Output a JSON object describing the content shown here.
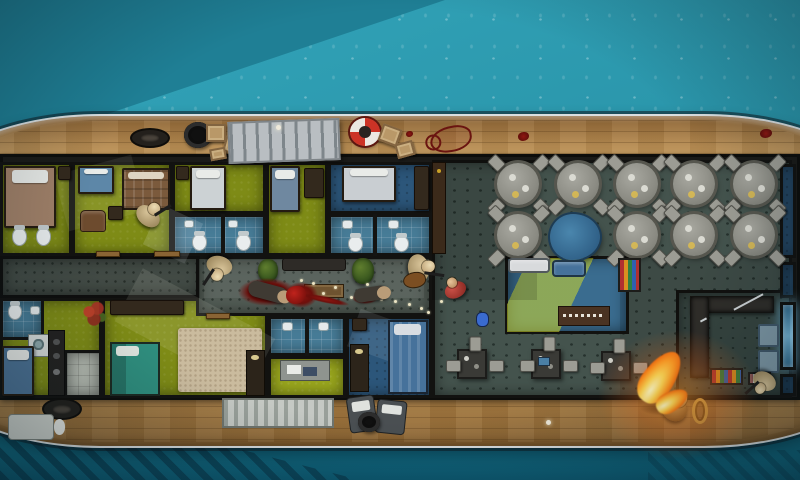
{
  "scene": {
    "description": "top-down-tactical-ship-raid-map",
    "environment": "yacht-on-teal-water",
    "palette": {
      "water_light": "#2e9db2",
      "water_dark": "#1f7f95",
      "water_deep": "#0d5a72",
      "hull_wood": "#c59a5d",
      "hull_rim": "#dadfe1",
      "wall": "#121210",
      "cabin_green": "#7e8b16",
      "bathroom_blue": "#477c97",
      "bedroom_blue": "#2c567a",
      "corridor_gray": "#515b54",
      "restaurant_gray": "#44534d",
      "blood_red": "#8e1712",
      "fire_orange": "#ff9c25",
      "lifebuoy_red": "#cc3326"
    }
  },
  "rooms": [
    {
      "t": "room f-green",
      "n": "cabin-port-1",
      "x": 0,
      "y": 162,
      "w": 72,
      "h": 94
    },
    {
      "t": "room f-green",
      "n": "cabin-port-2",
      "x": 72,
      "y": 162,
      "w": 100,
      "h": 94
    },
    {
      "t": "room f-green",
      "n": "cabin-port-3",
      "x": 172,
      "y": 162,
      "w": 94,
      "h": 52
    },
    {
      "t": "room f-bath",
      "n": "bathroom-port-3",
      "x": 172,
      "y": 214,
      "w": 94,
      "h": 42
    },
    {
      "t": "room f-green",
      "n": "cabin-port-4",
      "x": 266,
      "y": 162,
      "w": 62,
      "h": 94
    },
    {
      "t": "room f-bluedark",
      "n": "bedroom-port-5",
      "x": 328,
      "y": 162,
      "w": 104,
      "h": 52
    },
    {
      "t": "room f-bath",
      "n": "bathroom-port-5",
      "x": 328,
      "y": 214,
      "w": 104,
      "h": 42
    },
    {
      "t": "room f-green",
      "n": "cabin-stern-1",
      "x": 0,
      "y": 298,
      "w": 102,
      "h": 100
    },
    {
      "t": "room f-bath",
      "n": "bathroom-stern-1",
      "x": 0,
      "y": 298,
      "w": 44,
      "h": 42
    },
    {
      "t": "room f-tile",
      "n": "tile-room-stern",
      "x": 64,
      "y": 350,
      "w": 38,
      "h": 48
    },
    {
      "t": "room f-green",
      "n": "cabin-stern-2",
      "x": 102,
      "y": 298,
      "w": 166,
      "h": 100
    },
    {
      "t": "room f-bath",
      "n": "bathroom-stern-3",
      "x": 268,
      "y": 316,
      "w": 78,
      "h": 40
    },
    {
      "t": "room f-greenlit",
      "n": "office-stern",
      "x": 268,
      "y": 356,
      "w": 78,
      "h": 42
    },
    {
      "t": "room f-bluedark",
      "n": "bedroom-stern-4",
      "x": 346,
      "y": 316,
      "w": 86,
      "h": 82
    },
    {
      "t": "room f-rest",
      "n": "restaurant",
      "x": 432,
      "y": 160,
      "w": 360,
      "h": 238
    },
    {
      "t": "room f-blue",
      "n": "lounge",
      "x": 505,
      "y": 256,
      "w": 124,
      "h": 78
    },
    {
      "t": "room f-rest2",
      "n": "galley",
      "x": 676,
      "y": 290,
      "w": 116,
      "h": 108
    },
    {
      "t": "room f-bluedark",
      "n": "cold-room-1",
      "x": 780,
      "y": 164,
      "w": 16,
      "h": 94
    },
    {
      "t": "room f-bluedark",
      "n": "cold-room-2",
      "x": 780,
      "y": 262,
      "w": 16,
      "h": 36
    },
    {
      "t": "room f-blueglow",
      "n": "freezer-room",
      "x": 780,
      "y": 302,
      "w": 16,
      "h": 68
    },
    {
      "t": "room f-bluedark",
      "n": "cold-room-4",
      "x": 780,
      "y": 374,
      "w": 16,
      "h": 22
    },
    {
      "t": "room f-corridor",
      "n": "corridor-west",
      "x": 0,
      "y": 256,
      "w": 204,
      "h": 42
    },
    {
      "t": "room f-corridor",
      "n": "corridor-east",
      "x": 196,
      "y": 256,
      "w": 236,
      "h": 60
    }
  ],
  "beams": [
    {
      "t": "beam",
      "n": "light-wedge-bathroom",
      "x": 150,
      "y": 212,
      "w": 46,
      "h": 44,
      "r": 25,
      "c": "rgba(240,248,255,0.14)"
    },
    {
      "t": "beam",
      "n": "shadow-corridor-west",
      "x": 0,
      "y": 256,
      "w": 200,
      "h": 42,
      "c": "rgba(0,0,0,0.18)"
    },
    {
      "t": "beam",
      "n": "light-wedge-corridor",
      "x": 204,
      "y": 260,
      "w": 220,
      "h": 38,
      "c": "rgba(255,255,255,0.06)"
    },
    {
      "t": "beam",
      "n": "light-wedge-cabin-stern",
      "x": 120,
      "y": 300,
      "w": 150,
      "h": 60,
      "r": 28,
      "c": "rgba(255,255,235,0.10)"
    },
    {
      "t": "beam",
      "n": "light-wedge-bedroom-stern",
      "x": 352,
      "y": 318,
      "w": 62,
      "h": 40,
      "r": 20,
      "c": "rgba(240,248,255,0.10)"
    },
    {
      "t": "beam beam-diag",
      "n": "light-beam-lounge",
      "x": 507,
      "y": 258,
      "w": 120,
      "h": 74,
      "c": "rgba(0,0,0,0)"
    },
    {
      "t": "beam",
      "n": "shadow-restaurant-west",
      "x": 432,
      "y": 160,
      "w": 105,
      "h": 140,
      "c": "rgba(0,0,0,0.14)"
    },
    {
      "t": "beam",
      "n": "shadow-restaurant-east",
      "x": 620,
      "y": 255,
      "w": 170,
      "h": 140,
      "c": "rgba(0,0,0,0.10)"
    },
    {
      "t": "beam",
      "n": "light-wedge-cabin-port",
      "x": 60,
      "y": 164,
      "w": 80,
      "h": 58,
      "r": -15,
      "c": "rgba(255,255,235,0.08)"
    }
  ],
  "furniture": [
    {
      "t": "bed",
      "n": "bed-double-brown",
      "x": 4,
      "y": 166,
      "w": 52,
      "h": 62,
      "c": "#a08068"
    },
    {
      "t": "toilet",
      "n": "toilet",
      "x": 12,
      "y": 228,
      "w": 15,
      "h": 18
    },
    {
      "t": "toilet",
      "n": "toilet",
      "x": 36,
      "y": 228,
      "w": 15,
      "h": 18
    },
    {
      "t": "nightstand",
      "n": "nightstand",
      "x": 58,
      "y": 166,
      "w": 13,
      "h": 14
    },
    {
      "t": "bed",
      "n": "bed-single-blue",
      "x": 78,
      "y": 166,
      "w": 36,
      "h": 28,
      "c": "#5d87a8"
    },
    {
      "t": "bed-plaid",
      "n": "bed-double-plaid",
      "x": 122,
      "y": 168,
      "w": 48,
      "h": 42
    },
    {
      "t": "armchair",
      "n": "armchair",
      "x": 80,
      "y": 210,
      "w": 26,
      "h": 22
    },
    {
      "t": "nightstand",
      "n": "nightstand",
      "x": 108,
      "y": 206,
      "w": 15,
      "h": 14
    },
    {
      "t": "bed",
      "n": "bed-single-white",
      "x": 190,
      "y": 166,
      "w": 36,
      "h": 44,
      "c": "#ccd2d4"
    },
    {
      "t": "nightstand",
      "n": "nightstand",
      "x": 176,
      "y": 166,
      "w": 13,
      "h": 14
    },
    {
      "t": "sink",
      "n": "sink",
      "x": 184,
      "y": 220,
      "w": 10,
      "h": 8
    },
    {
      "t": "sink",
      "n": "sink",
      "x": 228,
      "y": 220,
      "w": 10,
      "h": 8
    },
    {
      "t": "toilet",
      "n": "toilet",
      "x": 192,
      "y": 234,
      "w": 15,
      "h": 17
    },
    {
      "t": "toilet",
      "n": "toilet",
      "x": 236,
      "y": 234,
      "w": 15,
      "h": 17
    },
    {
      "t": "wallseg",
      "n": "stall-divider",
      "x": 221,
      "y": 214,
      "w": 4,
      "h": 42
    },
    {
      "t": "bed",
      "n": "bed-single-blue",
      "x": 270,
      "y": 166,
      "w": 30,
      "h": 46,
      "c": "#6f88a0"
    },
    {
      "t": "dresser",
      "n": "dresser",
      "x": 304,
      "y": 168,
      "w": 20,
      "h": 30
    },
    {
      "t": "bed",
      "n": "bed-double-white",
      "x": 342,
      "y": 166,
      "w": 54,
      "h": 36,
      "c": "#c9ced2"
    },
    {
      "t": "dresser",
      "n": "wardrobe",
      "x": 414,
      "y": 166,
      "w": 15,
      "h": 44
    },
    {
      "t": "sink",
      "n": "sink",
      "x": 342,
      "y": 220,
      "w": 11,
      "h": 9
    },
    {
      "t": "sink",
      "n": "sink",
      "x": 388,
      "y": 220,
      "w": 11,
      "h": 9
    },
    {
      "t": "toilet",
      "n": "toilet",
      "x": 348,
      "y": 236,
      "w": 15,
      "h": 16
    },
    {
      "t": "toilet",
      "n": "toilet",
      "x": 394,
      "y": 236,
      "w": 15,
      "h": 16
    },
    {
      "t": "wallseg",
      "n": "stall-divider",
      "x": 373,
      "y": 214,
      "w": 4,
      "h": 42
    },
    {
      "t": "bench",
      "n": "corridor-bench",
      "x": 282,
      "y": 258,
      "w": 64,
      "h": 13
    },
    {
      "t": "plant",
      "n": "potted-plant",
      "x": 258,
      "y": 259,
      "w": 20,
      "h": 23
    },
    {
      "t": "plant",
      "n": "potted-plant",
      "x": 352,
      "y": 258,
      "w": 22,
      "h": 26
    },
    {
      "t": "crate-wood",
      "n": "wooden-chest",
      "x": 304,
      "y": 284,
      "w": 40,
      "h": 14
    },
    {
      "t": "door",
      "n": "door",
      "x": 154,
      "y": 251,
      "w": 26,
      "h": 6
    },
    {
      "t": "door",
      "n": "door",
      "x": 96,
      "y": 251,
      "w": 24,
      "h": 6
    },
    {
      "t": "door",
      "n": "door",
      "x": 206,
      "y": 313,
      "w": 24,
      "h": 6
    },
    {
      "t": "rose",
      "n": "rose-decal",
      "x": 80,
      "y": 300,
      "w": 28,
      "h": 28
    },
    {
      "t": "washer",
      "n": "washing-machine",
      "x": 28,
      "y": 334,
      "w": 21,
      "h": 23
    },
    {
      "t": "kitchen-strip",
      "n": "kitchenette",
      "x": 48,
      "y": 330,
      "w": 17,
      "h": 66
    },
    {
      "t": "bed",
      "n": "bed-single-blue",
      "x": 2,
      "y": 346,
      "w": 32,
      "h": 50,
      "c": "#4d7396"
    },
    {
      "t": "toilet",
      "n": "toilet",
      "x": 8,
      "y": 304,
      "w": 14,
      "h": 16
    },
    {
      "t": "sink",
      "n": "sink",
      "x": 30,
      "y": 306,
      "w": 10,
      "h": 9
    },
    {
      "t": "dresser",
      "n": "wardrobe",
      "x": 110,
      "y": 300,
      "w": 74,
      "h": 15
    },
    {
      "t": "rug",
      "n": "tan-rug",
      "x": 178,
      "y": 328,
      "w": 84,
      "h": 64
    },
    {
      "t": "bed-teal",
      "n": "bed-double-teal",
      "x": 110,
      "y": 342,
      "w": 50,
      "h": 54
    },
    {
      "t": "desk-dark",
      "n": "desk-lamp",
      "x": 246,
      "y": 350,
      "w": 19,
      "h": 46
    },
    {
      "t": "sink",
      "n": "sink",
      "x": 282,
      "y": 322,
      "w": 11,
      "h": 9
    },
    {
      "t": "sink",
      "n": "sink",
      "x": 318,
      "y": 322,
      "w": 11,
      "h": 9
    },
    {
      "t": "wallseg",
      "n": "stall-divider",
      "x": 305,
      "y": 316,
      "w": 4,
      "h": 40
    },
    {
      "t": "desk-gray",
      "n": "office-desk",
      "x": 280,
      "y": 360,
      "w": 50,
      "h": 21
    },
    {
      "t": "bed-stripe",
      "n": "bed-single-striped",
      "x": 388,
      "y": 320,
      "w": 40,
      "h": 74
    },
    {
      "t": "desk-dark",
      "n": "desk",
      "x": 350,
      "y": 344,
      "w": 19,
      "h": 48
    },
    {
      "t": "nightstand",
      "n": "nightstand",
      "x": 352,
      "y": 318,
      "w": 15,
      "h": 13
    },
    {
      "t": "bar-shelf",
      "n": "bar-bottle-shelf",
      "x": 432,
      "y": 162,
      "w": 14,
      "h": 92
    },
    {
      "t": "table-round",
      "n": "dining-table",
      "x": 497,
      "y": 163,
      "w": 42,
      "h": 42
    },
    {
      "t": "table-round",
      "n": "dining-table",
      "x": 557,
      "y": 163,
      "w": 42,
      "h": 42
    },
    {
      "t": "table-round",
      "n": "dining-table",
      "x": 616,
      "y": 163,
      "w": 42,
      "h": 42
    },
    {
      "t": "table-round",
      "n": "dining-table",
      "x": 673,
      "y": 163,
      "w": 42,
      "h": 42
    },
    {
      "t": "table-round",
      "n": "dining-table",
      "x": 733,
      "y": 163,
      "w": 42,
      "h": 42
    },
    {
      "t": "table-round",
      "n": "dining-table",
      "x": 497,
      "y": 214,
      "w": 42,
      "h": 42
    },
    {
      "t": "table-round",
      "n": "dining-table",
      "x": 616,
      "y": 214,
      "w": 42,
      "h": 42
    },
    {
      "t": "table-round",
      "n": "dining-table",
      "x": 673,
      "y": 214,
      "w": 42,
      "h": 42
    },
    {
      "t": "table-round",
      "n": "dining-table",
      "x": 733,
      "y": 214,
      "w": 42,
      "h": 42
    },
    {
      "t": "piano",
      "n": "grand-piano-blue",
      "x": 550,
      "y": 214,
      "w": 50,
      "h": 46
    },
    {
      "t": "bag",
      "n": "blue-duffel-bag",
      "x": 476,
      "y": 312,
      "w": 13,
      "h": 15
    },
    {
      "t": "desk-sq",
      "n": "work-desk",
      "x": 457,
      "y": 349,
      "w": 30,
      "h": 30
    },
    {
      "t": "desk-sq",
      "n": "work-desk",
      "x": 531,
      "y": 349,
      "w": 30,
      "h": 30
    },
    {
      "t": "desk-sq",
      "n": "work-desk",
      "x": 601,
      "y": 351,
      "w": 30,
      "h": 30
    },
    {
      "t": "laptop",
      "n": "laptop",
      "x": 538,
      "y": 357,
      "w": 12,
      "h": 9
    },
    {
      "t": "couch",
      "n": "couch-white",
      "x": 508,
      "y": 258,
      "w": 42,
      "h": 15,
      "c": "#d8dadc"
    },
    {
      "t": "couch",
      "n": "couch-blue",
      "x": 552,
      "y": 260,
      "w": 34,
      "h": 17,
      "c": "#46729b"
    },
    {
      "t": "console",
      "n": "sound-console",
      "x": 558,
      "y": 306,
      "w": 52,
      "h": 20
    },
    {
      "t": "shelf-color",
      "n": "magazine-shelf",
      "x": 618,
      "y": 258,
      "w": 23,
      "h": 34
    },
    {
      "t": "counter",
      "n": "galley-counter-top",
      "x": 690,
      "y": 296,
      "w": 84,
      "h": 17
    },
    {
      "t": "counter",
      "n": "galley-counter-side",
      "x": 690,
      "y": 296,
      "w": 19,
      "h": 82
    },
    {
      "t": "prep",
      "n": "prep-table",
      "x": 758,
      "y": 324,
      "w": 21,
      "h": 23
    },
    {
      "t": "prep",
      "n": "prep-table",
      "x": 758,
      "y": 350,
      "w": 21,
      "h": 23
    },
    {
      "t": "shelf-color",
      "n": "food-shelf",
      "x": 710,
      "y": 368,
      "w": 33,
      "h": 17
    },
    {
      "t": "shelf-white",
      "n": "food-shelf-small",
      "x": 748,
      "y": 372,
      "w": 23,
      "h": 13
    }
  ],
  "deck": [
    {
      "t": "cleat",
      "n": "mooring-cleat",
      "x": 130,
      "y": 128,
      "w": 40,
      "h": 20
    },
    {
      "t": "tire",
      "n": "tire-fender",
      "x": 184,
      "y": 122,
      "w": 28,
      "h": 26
    },
    {
      "t": "crate",
      "n": "crate",
      "x": 206,
      "y": 124,
      "w": 20,
      "h": 18
    },
    {
      "t": "crate",
      "n": "crate",
      "x": 224,
      "y": 138,
      "w": 20,
      "h": 16,
      "r": 15
    },
    {
      "t": "crate",
      "n": "crate",
      "x": 210,
      "y": 148,
      "w": 16,
      "h": 12,
      "r": -10
    },
    {
      "t": "gangway",
      "n": "gangway-ramp",
      "x": 228,
      "y": 120,
      "w": 112,
      "h": 42
    },
    {
      "t": "deck-dot",
      "n": "deck-light",
      "x": 276,
      "y": 125,
      "w": 5,
      "h": 5
    },
    {
      "t": "lifebuoy",
      "n": "lifebuoy",
      "x": 350,
      "y": 118,
      "w": 30,
      "h": 28
    },
    {
      "t": "crate",
      "n": "crate",
      "x": 380,
      "y": 126,
      "w": 20,
      "h": 18,
      "r": 20
    },
    {
      "t": "crate",
      "n": "crate",
      "x": 396,
      "y": 142,
      "w": 18,
      "h": 15,
      "r": -15
    },
    {
      "t": "body-outline",
      "n": "blood-body-outline",
      "x": 430,
      "y": 126,
      "w": 42,
      "h": 26
    },
    {
      "t": "blood-dot",
      "n": "blood-spot",
      "x": 406,
      "y": 131,
      "w": 7,
      "h": 6
    },
    {
      "t": "blood-dot",
      "n": "blood-spot",
      "x": 518,
      "y": 132,
      "w": 11,
      "h": 9
    },
    {
      "t": "blood-dot",
      "n": "blood-spot",
      "x": 760,
      "y": 129,
      "w": 12,
      "h": 9
    },
    {
      "t": "cleat",
      "n": "mooring-cleat",
      "x": 42,
      "y": 398,
      "w": 40,
      "h": 22
    },
    {
      "t": "lounger-white",
      "n": "deck-lounger-white",
      "x": 8,
      "y": 414,
      "w": 46,
      "h": 26
    },
    {
      "t": "hatch",
      "n": "deck-hatch",
      "x": 222,
      "y": 398,
      "w": 112,
      "h": 30
    },
    {
      "t": "lounger",
      "n": "deck-lounger",
      "x": 348,
      "y": 396,
      "w": 28,
      "h": 36,
      "r": -8
    },
    {
      "t": "lounger",
      "n": "deck-lounger",
      "x": 376,
      "y": 400,
      "w": 30,
      "h": 34,
      "r": 6
    },
    {
      "t": "tire",
      "n": "tire-fender",
      "x": 358,
      "y": 412,
      "w": 22,
      "h": 20
    },
    {
      "t": "deck-dot",
      "n": "deck-light",
      "x": 546,
      "y": 420,
      "w": 5,
      "h": 5
    },
    {
      "t": "rope",
      "n": "rope-coil",
      "x": 692,
      "y": 398,
      "w": 16,
      "h": 26
    }
  ],
  "blood": [
    {
      "t": "blood",
      "n": "blood-pool",
      "x": 238,
      "y": 278,
      "w": 58,
      "h": 28
    },
    {
      "t": "blood",
      "n": "blood-pool-bright",
      "x": 284,
      "y": 282,
      "w": 34,
      "h": 26
    },
    {
      "t": "blood",
      "n": "blood-smear",
      "x": 300,
      "y": 296,
      "w": 50,
      "h": 7,
      "r": 12
    },
    {
      "t": "blood",
      "n": "blood-pool",
      "x": 352,
      "y": 292,
      "w": 26,
      "h": 12
    },
    {
      "t": "scorch",
      "n": "scorch-mark",
      "x": 640,
      "y": 400,
      "w": 52,
      "h": 16
    }
  ],
  "casings": [
    [
      300,
      279
    ],
    [
      312,
      282
    ],
    [
      322,
      292
    ],
    [
      334,
      286
    ],
    [
      350,
      296
    ],
    [
      366,
      283
    ],
    [
      380,
      298
    ],
    [
      394,
      300
    ],
    [
      408,
      303
    ],
    [
      420,
      307
    ],
    [
      427,
      311
    ],
    [
      440,
      300
    ]
  ],
  "characters": [
    {
      "t": "enemy",
      "n": "enemy-cabin-port",
      "x": 136,
      "y": 200,
      "w": 26,
      "h": 30,
      "r": 40
    },
    {
      "t": "enemy",
      "n": "enemy-corridor-west",
      "x": 206,
      "y": 252,
      "w": 26,
      "h": 30,
      "r": 195
    },
    {
      "t": "enemy-guitar",
      "n": "enemy-corridor-east",
      "x": 406,
      "y": 252,
      "w": 28,
      "h": 32,
      "r": 80
    },
    {
      "t": "civ",
      "n": "civilian-red-shirt",
      "x": 444,
      "y": 276,
      "w": 22,
      "h": 26,
      "r": -25
    },
    {
      "t": "enemy",
      "n": "enemy-galley",
      "x": 752,
      "y": 368,
      "w": 24,
      "h": 28,
      "r": 210
    },
    {
      "t": "deadbody",
      "n": "dead-body",
      "x": 248,
      "y": 284,
      "w": 40,
      "h": 16,
      "r": 15
    },
    {
      "t": "deadbody",
      "n": "dead-body",
      "x": 354,
      "y": 287,
      "w": 34,
      "h": 14,
      "r": -8
    },
    {
      "t": "redblob",
      "n": "dead-body-red",
      "x": 286,
      "y": 286,
      "w": 20,
      "h": 18
    },
    {
      "t": "body-burn",
      "n": "burning-victim",
      "x": 662,
      "y": 390,
      "w": 26,
      "h": 36,
      "r": 35
    }
  ],
  "effects": [
    {
      "t": "glow",
      "n": "fire-glow",
      "x": 598,
      "y": 330,
      "w": 160,
      "h": 130
    },
    {
      "t": "flame",
      "n": "fire-flame-large",
      "x": 644,
      "y": 348,
      "w": 32,
      "h": 58,
      "r": 35
    },
    {
      "t": "flame",
      "n": "fire-flame-small",
      "x": 662,
      "y": 384,
      "w": 20,
      "h": 34,
      "r": 60
    }
  ]
}
